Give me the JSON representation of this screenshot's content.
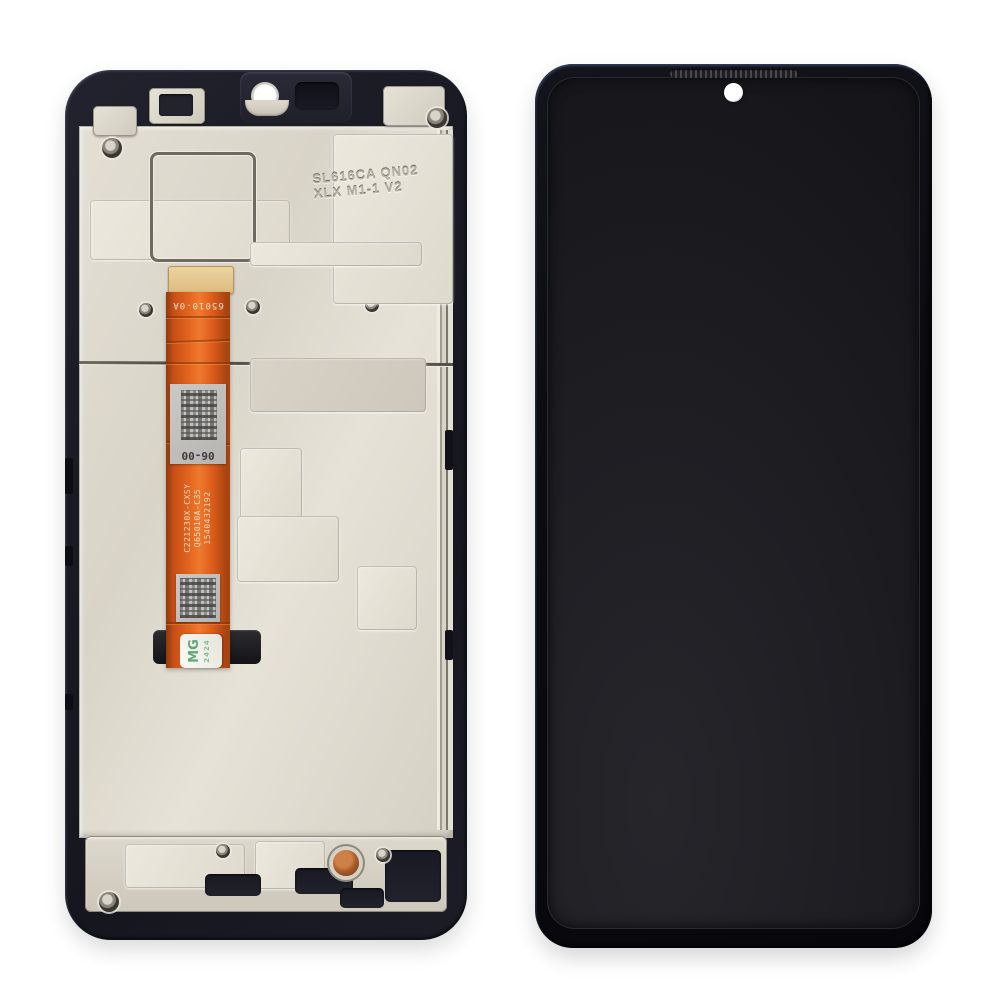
{
  "scene": {
    "description": "Product photo of a smartphone LCD display assembly spare part: back side with middle frame and orange flex cable on the left, assembled black front display on the right",
    "background_color": "#ffffff"
  },
  "back_frame": {
    "engraving_line1": "SL616CA QN02",
    "engraving_line2": "XLX M1-1 V2",
    "frame_color": "#1b1b25",
    "plate_color": "#ddd8cc",
    "copper_contact_color": "#a85a28"
  },
  "flex_cable": {
    "marking_top": "65010-0A",
    "label1_code": "06-00",
    "serial_line1": "1540432192",
    "serial_line2": "Q65010A-C35",
    "serial_line3": "C221230X-CXSY",
    "sticker_text": "MG",
    "sticker_subtext": "2424",
    "cable_color": "#e4671f",
    "stiffener_color": "#dcba7e"
  },
  "front_display": {
    "bezel_color": "#0b0b10",
    "screen_color": "#1c1c21",
    "camera_hole_color": "#ffffff",
    "earpiece_mesh_color": "#2a2a2e"
  }
}
